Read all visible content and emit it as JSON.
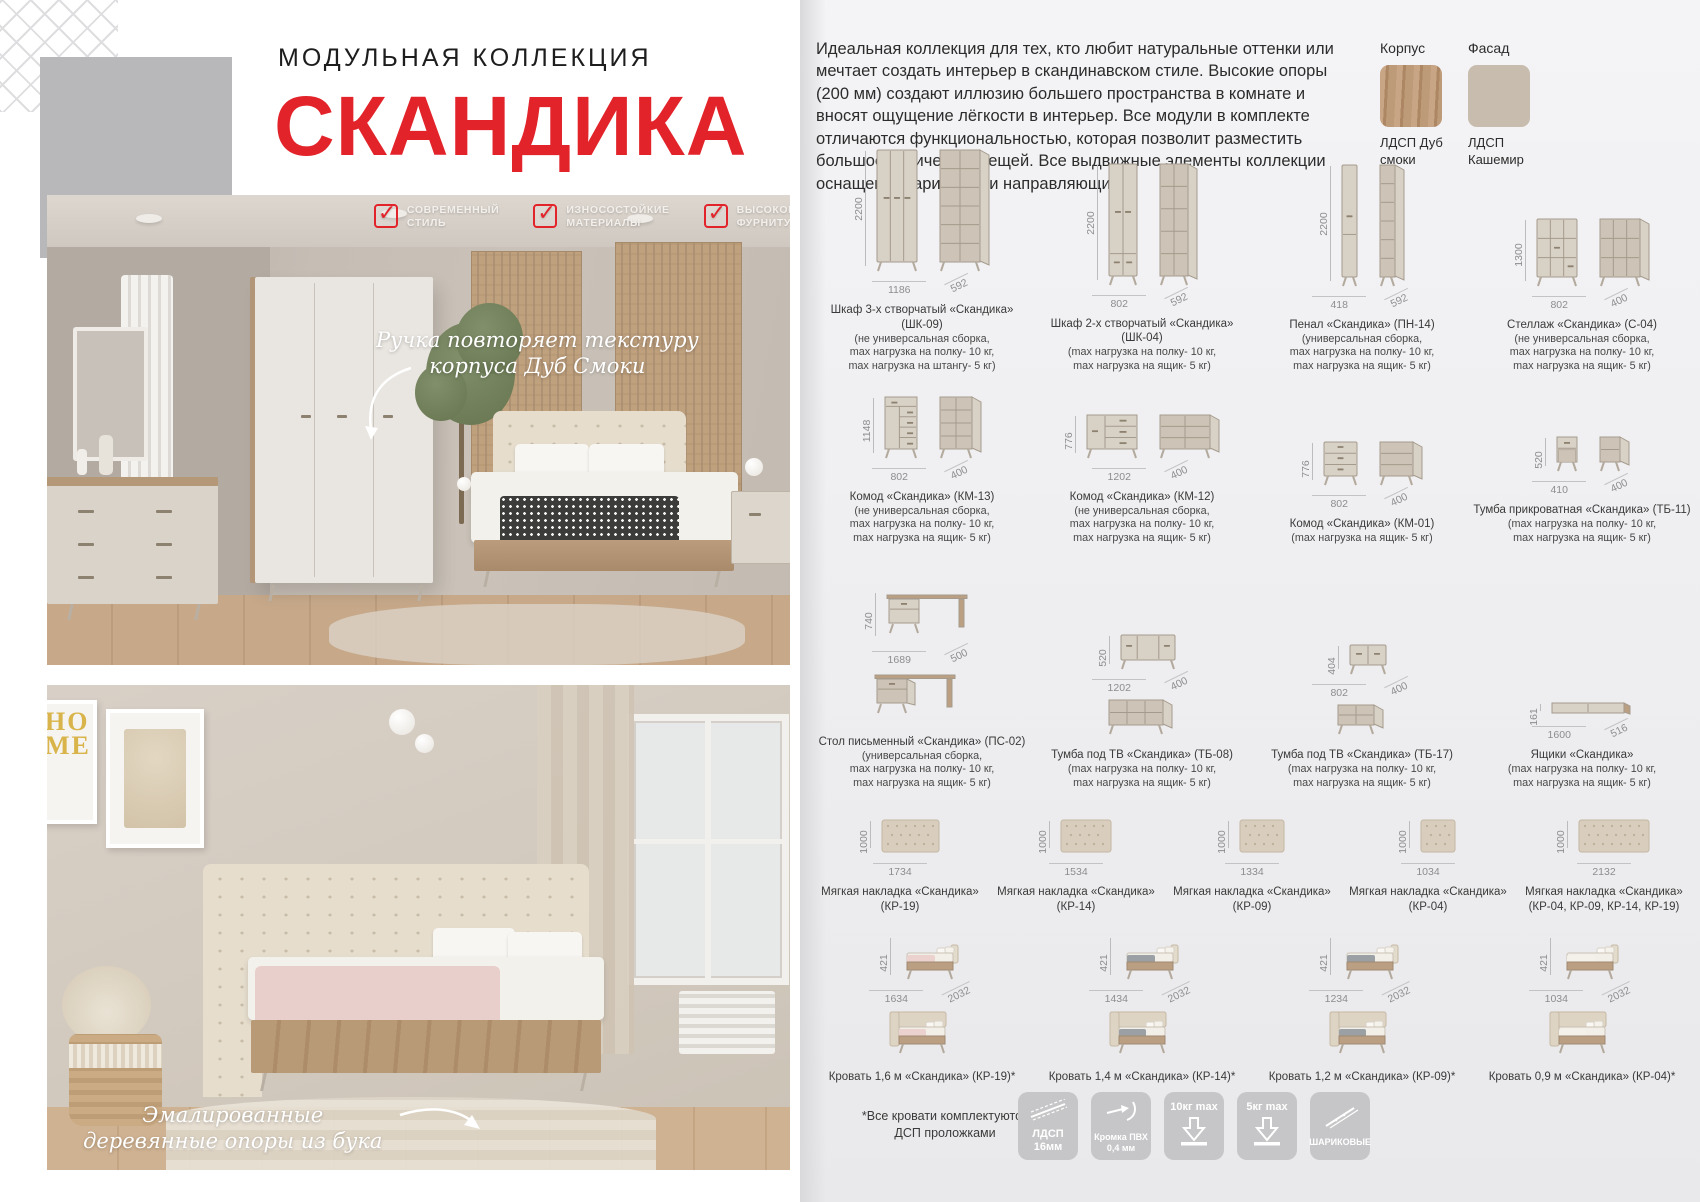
{
  "header": {
    "collection_label": "МОДУЛЬНАЯ КОЛЛЕКЦИЯ",
    "title": "СКАНДИКА"
  },
  "colors": {
    "accent_red": "#e2232a",
    "korpus_wood": "#b5947a",
    "fasad_cashmere": "#c7bcae"
  },
  "badges": [
    {
      "label": "СОВРЕМЕННЫЙ СТИЛЬ"
    },
    {
      "label": "ИЗНОСОСТОЙКИЕ МАТЕРИАЛЫ"
    },
    {
      "label": "ВЫСОКОКАЧЕСТВЕ ФУРНИТУРА"
    }
  ],
  "photo_top": {
    "annotation": "Ручка повторяет текстуру корпуса Дуб Смоки"
  },
  "photo_bottom": {
    "annotation": "Эмалированные деревянные опоры из бука",
    "poster_text": "HO ME"
  },
  "intro": "Идеальная коллекция для тех, кто любит натуральные оттенки или мечтает создать интерьер в скандинавском стиле. Высокие опоры (200 мм) создают иллюзию большего пространства в комнате и вносят ощущение лёгкости в интерьер. Все модули в комплекте отличаются функциональностью, которая позволит разместить большое количество вещей. Все выдвижные элементы коллекции оснащены шариковыми направляющими.",
  "materials": {
    "korpus_label": "Корпус",
    "korpus_name": "ЛДСП Дуб смоки",
    "fasad_label": "Фасад",
    "fasad_name": "ЛДСП Кашемир"
  },
  "catalog": {
    "rows": [
      {
        "top": 194,
        "height": 180,
        "items": [
          {
            "kind": "wardrobe3",
            "views": "pair",
            "name": "Шкаф 3-х створчатый «Скандика» (ШК-09)",
            "note_lines": [
              "(не универсальная сборка,",
              "max нагрузка на полку- 10 кг,",
              "max нагрузка на штангу- 5 кг)"
            ],
            "dim_h": "2200",
            "dim_w": "1186",
            "dim_d": "592"
          },
          {
            "kind": "wardrobe2",
            "views": "pair",
            "name": "Шкаф 2-х створчатый «Скандика» (ШК-04)",
            "note_lines": [
              "(max нагрузка на полку- 10 кг,",
              "max нагрузка на ящик- 5 кг)"
            ],
            "dim_h": "2200",
            "dim_w": "802",
            "dim_d": "592"
          },
          {
            "kind": "penal",
            "views": "pair",
            "name": "Пенал «Скандика» (ПН-14)",
            "note_lines": [
              "(универсальная сборка,",
              "max нагрузка на полку- 10 кг,",
              "max нагрузка на ящик- 5 кг)"
            ],
            "dim_h": "2200",
            "dim_w": "418",
            "dim_d": "592"
          },
          {
            "kind": "stellazh",
            "views": "pair",
            "name": "Стеллаж «Скандика» (С-04)",
            "note_lines": [
              "(не универсальная сборка,",
              "max нагрузка на полку- 10 кг,",
              "max нагрузка на ящик- 5 кг)"
            ],
            "dim_h": "1300",
            "dim_w": "802",
            "dim_d": "400"
          }
        ]
      },
      {
        "top": 376,
        "height": 170,
        "items": [
          {
            "kind": "km13",
            "views": "pair",
            "name": "Комод «Скандика» (КМ-13)",
            "note_lines": [
              "(не универсальная сборка,",
              "max нагрузка на полку- 10 кг,",
              "max нагрузка на ящик- 5 кг)"
            ],
            "dim_h": "1148",
            "dim_w": "802",
            "dim_d": "400"
          },
          {
            "kind": "km12",
            "views": "pair",
            "name": "Комод «Скандика» (КМ-12)",
            "note_lines": [
              "(не универсальная сборка,",
              "max нагрузка на полку- 10 кг,",
              "max нагрузка на ящик- 5 кг)"
            ],
            "dim_h": "776",
            "dim_w": "1202",
            "dim_d": "400"
          },
          {
            "kind": "km01",
            "views": "pair",
            "name": "Комод «Скандика» (КМ-01)",
            "note_lines": [
              "(max нагрузка на ящик- 5 кг)"
            ],
            "dim_h": "776",
            "dim_w": "802",
            "dim_d": "400"
          },
          {
            "kind": "tb11",
            "views": "pair",
            "name": "Тумба прикроватная «Скандика» (ТБ-11)",
            "note_lines": [
              "(max нагрузка на полку- 10 кг,",
              "max нагрузка на ящик- 5 кг)"
            ],
            "dim_h": "520",
            "dim_w": "410",
            "dim_d": "400"
          }
        ]
      },
      {
        "top": 549,
        "height": 242,
        "items": [
          {
            "kind": "desk",
            "views": "stack",
            "name": "Стол письменный «Скандика» (ПС-02)",
            "note_lines": [
              "(универсальная сборка,",
              "max нагрузка на полку- 10 кг,",
              "max нагрузка на ящик- 5 кг)"
            ],
            "dim_h": "740",
            "dim_w": "1689",
            "dim_d": "500"
          },
          {
            "kind": "tv08",
            "views": "stack",
            "name": "Тумба под ТВ «Скандика» (ТБ-08)",
            "note_lines": [
              "(max нагрузка на полку- 10 кг,",
              "max нагрузка на ящик- 5 кг)"
            ],
            "dim_h": "520",
            "dim_w": "1202",
            "dim_d": "400"
          },
          {
            "kind": "tv17",
            "views": "stack",
            "name": "Тумба под ТВ «Скандика» (ТБ-17)",
            "note_lines": [
              "(max нагрузка на полку- 10 кг,",
              "max нагрузка на ящик- 5 кг)"
            ],
            "dim_h": "404",
            "dim_w": "802",
            "dim_d": "400"
          },
          {
            "kind": "drawerbox",
            "views": "single",
            "name": "Ящики «Скандика»",
            "note_lines": [
              "(max нагрузка на полку- 10 кг,",
              "max нагрузка на ящик- 5 кг)"
            ],
            "dim_h": "161",
            "dim_w": "1600",
            "dim_d": "516"
          }
        ]
      },
      {
        "top": 793,
        "height": 122,
        "items": [
          {
            "kind": "panel",
            "pw": 57,
            "views": "single",
            "name": "Мягкая накладка «Скандика» (КР-19)",
            "note_lines": [],
            "dim_h": "1000",
            "dim_w": "1734",
            "dim_d": ""
          },
          {
            "kind": "panel",
            "pw": 50,
            "views": "single",
            "name": "Мягкая накладка «Скандика» (КР-14)",
            "note_lines": [],
            "dim_h": "1000",
            "dim_w": "1534",
            "dim_d": ""
          },
          {
            "kind": "panel",
            "pw": 44,
            "views": "single",
            "name": "Мягкая накладка «Скандика» (КР-09)",
            "note_lines": [],
            "dim_h": "1000",
            "dim_w": "1334",
            "dim_d": ""
          },
          {
            "kind": "panel",
            "pw": 34,
            "views": "single",
            "name": "Мягкая накладка «Скандика» (КР-04)",
            "note_lines": [],
            "dim_h": "1000",
            "dim_w": "1034",
            "dim_d": ""
          },
          {
            "kind": "panel",
            "pw": 70,
            "views": "single",
            "name": "Мягкая накладка «Скандика» (КР-04, КР-09, КР-14, КР-19)",
            "note_lines": [],
            "dim_h": "1000",
            "dim_w": "2132",
            "dim_d": ""
          }
        ]
      },
      {
        "top": 917,
        "height": 168,
        "items": [
          {
            "kind": "bed",
            "views": "stack",
            "blanket": "#ecd2cf",
            "name": "Кровать 1,6 м «Скандика» (КР-19)*",
            "note_lines": [],
            "dim_h": "421",
            "dim_w": "1634",
            "dim_d": "2032"
          },
          {
            "kind": "bed",
            "views": "stack",
            "blanket": "#9aa0a4",
            "name": "Кровать 1,4 м «Скандика» (КР-14)*",
            "note_lines": [],
            "dim_h": "421",
            "dim_w": "1434",
            "dim_d": "2032"
          },
          {
            "kind": "bed",
            "views": "stack",
            "blanket": "#9aa0a4",
            "name": "Кровать 1,2 м «Скандика» (КР-09)*",
            "note_lines": [],
            "dim_h": "421",
            "dim_w": "1234",
            "dim_d": "2032"
          },
          {
            "kind": "bed",
            "views": "stack",
            "blanket": "#f4f1ea",
            "name": "Кровать 0,9 м «Скандика» (КР-04)*",
            "note_lines": [],
            "dim_h": "421",
            "dim_w": "1034",
            "dim_d": "2032"
          }
        ]
      }
    ]
  },
  "footnote": "*Все кровати комплектуются ДСП проложками",
  "feature_icons": [
    {
      "icon": "ldsp-icon",
      "top": "",
      "bottom": "ЛДСП 16мм",
      "big": true
    },
    {
      "icon": "edge-icon",
      "top": "",
      "bottom": "Кромка ПВХ 0,4 мм",
      "big": false
    },
    {
      "icon": "load10-icon",
      "top": "10кг max",
      "bottom": "",
      "big": true
    },
    {
      "icon": "load5-icon",
      "top": "5кг max",
      "bottom": "",
      "big": true
    },
    {
      "icon": "slides-icon",
      "top": "",
      "bottom": "ШАРИКОВЫЕ",
      "big": false
    }
  ]
}
